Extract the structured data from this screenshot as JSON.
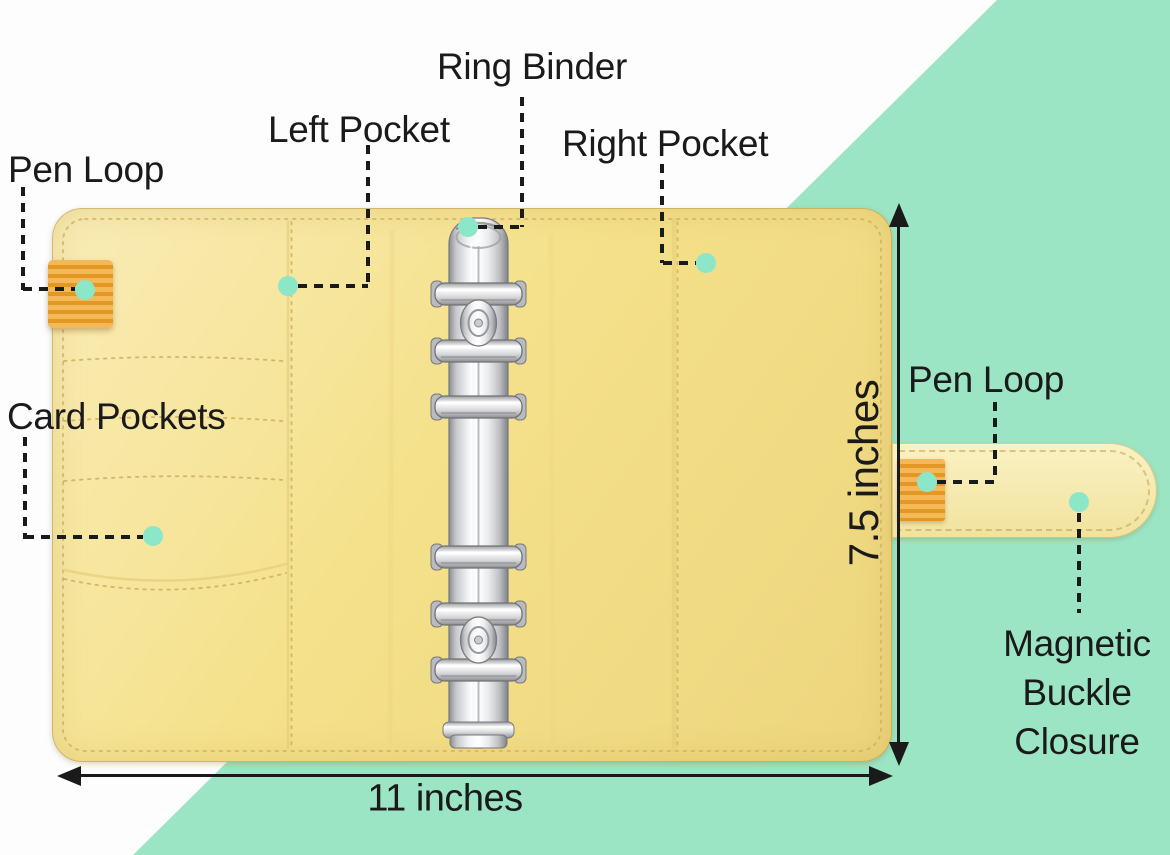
{
  "diagram": {
    "labels": {
      "pen_loop_left": "Pen Loop",
      "left_pocket": "Left Pocket",
      "ring_binder": "Ring Binder",
      "right_pocket": "Right Pocket",
      "card_pockets": "Card Pockets",
      "pen_loop_right": "Pen Loop",
      "magnetic_buckle_closure": "Magnetic Buckle Closure"
    },
    "dimensions": {
      "height": "7.5 inches",
      "width": "11 inches"
    },
    "colors": {
      "background_accent_green": "#9ce5c4",
      "binder_yellow": "#f5e18b",
      "strap_yellow": "#f8ecab",
      "tab_orange": "#f2a42a",
      "marker_dot_mint": "#8ce7c8",
      "text_black": "#1a1a1a"
    }
  }
}
